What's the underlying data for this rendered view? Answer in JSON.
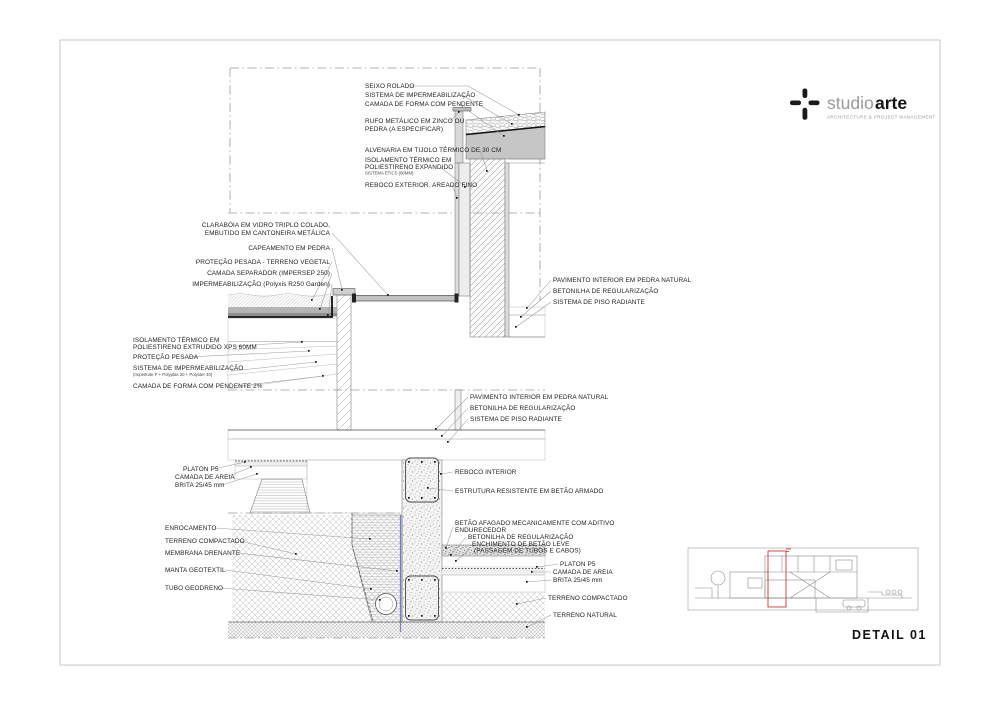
{
  "logo": {
    "name_light": "studio",
    "name_bold": "arte",
    "tagline": "ARCHITECTURE & PROJECT MANAGEMENT"
  },
  "title_block": {
    "detail_label": "DETAIL 01"
  },
  "colors": {
    "accent_red": "#cc2222",
    "membrane_blue": "#7a7ac8",
    "drawing_line": "#777777",
    "text": "#222222"
  },
  "annotations": {
    "seixo_rolado": "SEIXO ROLADO",
    "sistema_impermeabilizacao": "SISTEMA DE IMPERMEABILIZAÇÃO",
    "camada_forma_pendente": "CAMADA DE FORMA COM PENDENTE",
    "rufo": [
      "RUFO METÁLICO EM ZINCO OU",
      "PEDRA (A ESPECIFICAR)"
    ],
    "alvenaria": "ALVENARIA EM TIJOLO TÉRMICO DE 30 CM",
    "etics": [
      "ISOLAMENTO TÉRMICO EM",
      "POLIESTIRENO EXPANDIDO",
      "SISTEMA ETICS (80MM)"
    ],
    "reboco_exterior": "REBOCO EXTERIOR. AREADO FINO",
    "claraboia": [
      "CLARABÓIA EM VIDRO TRIPLO COLADO,",
      "EMBUTIDO EM CANTONEIRA METÁLICA"
    ],
    "capeamento": "CAPEAMENTO EM PEDRA",
    "protecao_vegetal": "PROTEÇÃO PESADA - TERRENO VEGETAL",
    "camada_separador": "CAMADA SEPARADOR (IMPERSEP 250)",
    "impermeabilizacao_garden": "IMPERMEABILIZAÇÃO (Polyxis R250 Garden)",
    "xps": [
      "ISOLAMENTO TÉRMICO EM",
      "POLIESTIRENO EXTRUDIDO XPS 60MM"
    ],
    "protecao_pesada": "PROTEÇÃO PESADA",
    "sistema_impermeabilizacao2": [
      "SISTEMA DE IMPERMEABILIZAÇÃO",
      "(Imperkote F + Polyplas 30 + Polyster 40)"
    ],
    "camada_forma_2": "CAMADA DE FORMA COM PENDENTE 2%",
    "pavimento_interior": "PAVIMENTO INTERIOR EM PEDRA NATURAL",
    "betonilha_regularizacao": "BETONILHA DE REGULARIZAÇÃO",
    "sistema_piso_radiante": "SISTEMA DE PISO RADIANTE",
    "reboco_interior": "REBOCO INTERIOR",
    "estrutura_resistente": "ESTRUTURA RESISTENTE EM BETÃO ARMADO",
    "platon": "PLATON P5",
    "camada_areia": "CAMADA DE AREIA",
    "brita": "BRITA 25/45 mm",
    "enrocamento": "ENROCAMENTO",
    "terreno_compactado": "TERRENO COMPACTADO",
    "membrana_drenante": "MEMBRANA DRENANTE",
    "manta_geotextil": "MANTA GEOTEXTIL",
    "tubo_geodreno": "TUBO GEODRENO",
    "betao_afagado": [
      "BETÃO AFAGADO MECANICAMENTE COM ADITIVO",
      "ENDURECEDOR"
    ],
    "enchimento": [
      "ENCHIMENTO DE BETÃO LEVE",
      "(PASSAGEM DE TUBOS E CABOS)"
    ],
    "terreno_natural": "TERRENO NATURAL"
  }
}
